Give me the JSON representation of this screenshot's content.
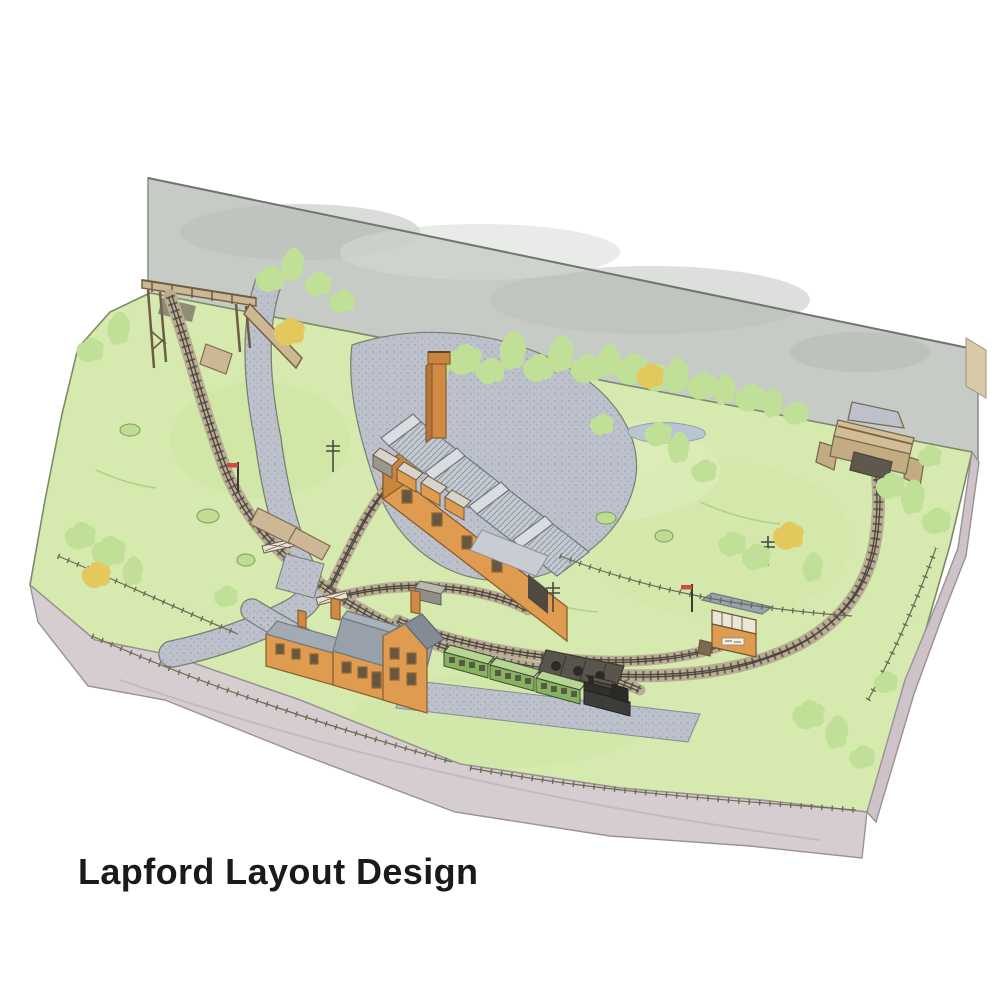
{
  "caption": {
    "title": "Lapford Layout Design"
  },
  "palette": {
    "backscene": "#c6cbc6",
    "grass": "#d6e9ae",
    "grass_shade": "#c9e49f",
    "tree_green": "#bfe096",
    "tree_yellow": "#e3c95c",
    "road": "#bdc1cb",
    "ballast": "#b9ad95",
    "sleeper": "#6b6156",
    "rail": "#4a443b",
    "fascia": "#d6cdd1",
    "fascia_side": "#cdc3c8",
    "brick": "#df9b4f",
    "brick_dark": "#c8853e",
    "roof_light": "#c3cad1",
    "roof_slate": "#98a1aa",
    "coach_green": "#85b35e",
    "coach_top": "#b7d593",
    "loco_black": "#3c3c38",
    "stone": "#cdb896",
    "water": "#b9c6d2",
    "fence": "#6b6a55",
    "title_color": "#1a1a1a"
  },
  "scene": {
    "alt": "Watercolour artist's impression of the Lapford model railway layout: a green baseboard diorama with grey backscene, curving single line between two bridge scenic exits, creamery factory with saw-tooth roof, station house, green coaches, signal box, country road with level crossing, trees and fences.",
    "features": [
      "grey backscene wall",
      "grass baseboard with painted fascia",
      "timber bridge over the line (left scenic exit)",
      "stone road overbridge (right scenic exit)",
      "country road with stippled surface",
      "level crossing with gates",
      "creamery factory with saw-tooth roof and tall chimney",
      "goods vans beside the factory siding",
      "station house with gabled wing and chimneys",
      "station platform and forecourt",
      "green passenger coaches",
      "black steam locomotive",
      "grey goods wagon",
      "coal staithes",
      "signal box",
      "small pond",
      "green and autumn-yellow trees",
      "post-and-rail fences",
      "telegraph poles and signals"
    ]
  }
}
